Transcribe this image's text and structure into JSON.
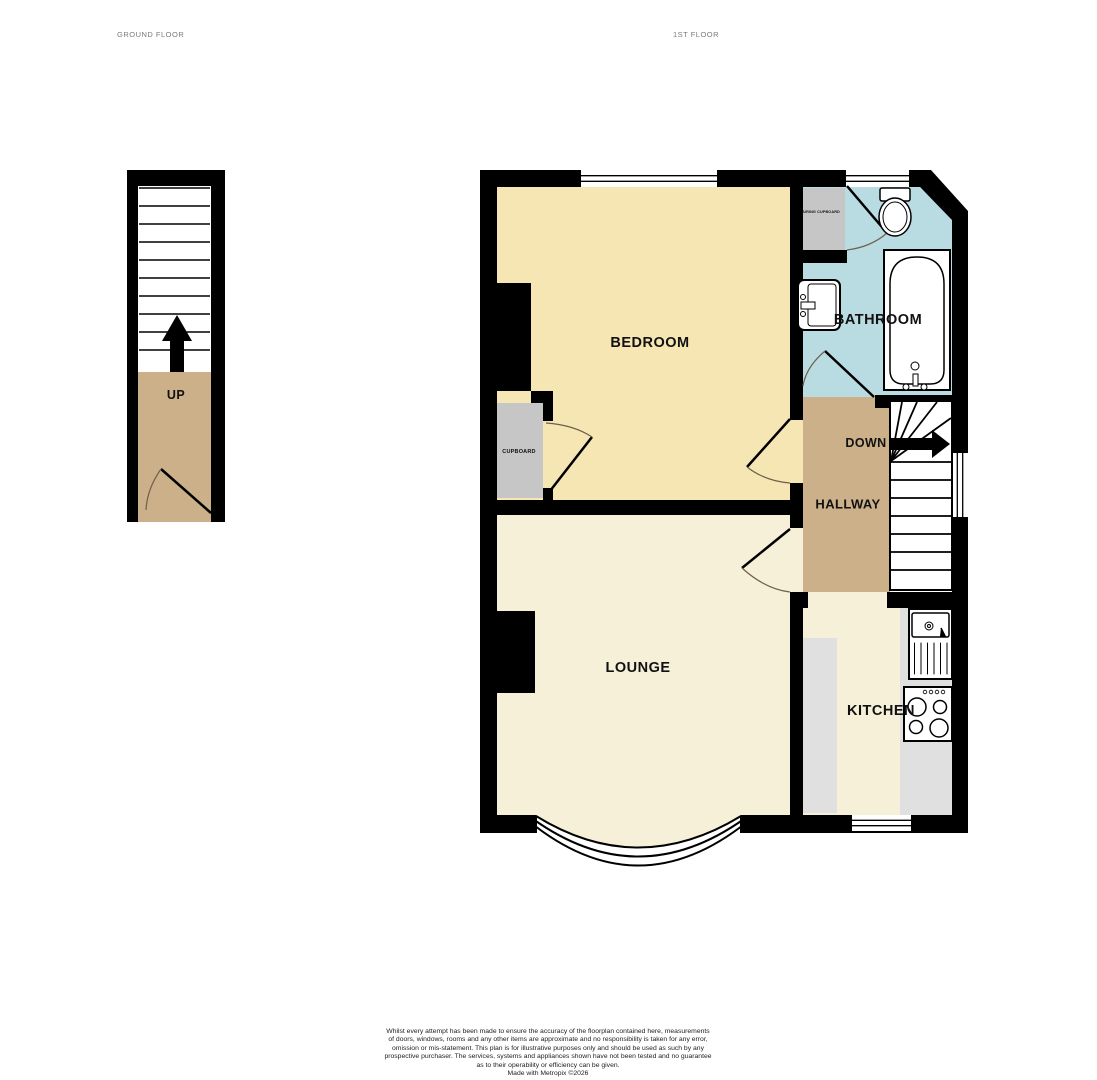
{
  "floors": {
    "ground": {
      "label": "GROUND FLOOR",
      "stairs_direction": "UP"
    },
    "first": {
      "label": "1ST FLOOR",
      "stairs_direction": "DOWN"
    }
  },
  "rooms": {
    "bedroom": {
      "label": "BEDROOM"
    },
    "bathroom": {
      "label": "BATHROOM"
    },
    "hallway": {
      "label": "HALLWAY"
    },
    "lounge": {
      "label": "LOUNGE"
    },
    "kitchen": {
      "label": "KITCHEN"
    },
    "cupboard": {
      "label": "CUPBOARD"
    },
    "airing_cupboard": {
      "label": "AIRING CUPBOARD"
    }
  },
  "palette": {
    "wall": "#000000",
    "bedroom_fill": "#F5E6B4",
    "bathroom_fill": "#B9DCE3",
    "hallway_fill": "#CBB08A",
    "lounge_kitchen_fill": "#F6F0D8",
    "cupboard_fill": "#C6C6C6",
    "counter_fill": "#E0E0E0",
    "floor_title_text": "#7b7b7b",
    "door_arc": "#70604a"
  },
  "footer": {
    "disclaimer_lines": [
      "Whilst every attempt has been made to ensure the accuracy of the floorplan contained here, measurements",
      "of doors, windows, rooms and any other items are approximate and no responsibility is taken for any error,",
      "omission or mis-statement. This plan is for illustrative purposes only and should be used as such by any",
      "prospective purchaser. The services, systems and appliances shown have not been tested and no guarantee",
      "as to their operability or efficiency can be given."
    ],
    "credit": "Made with Metropix ©2026"
  }
}
